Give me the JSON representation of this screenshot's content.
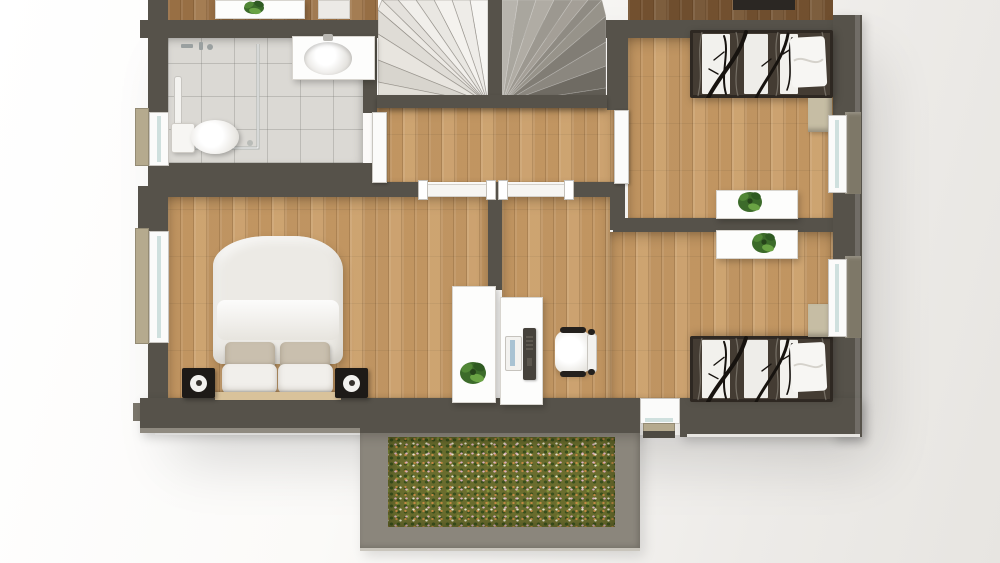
{
  "meta": {
    "description": "3D architectural floor plan, top-down render of an upper storey",
    "view": "top-down orthographic",
    "no_visible_text": true
  },
  "colors": {
    "wall": "#56524a",
    "wallLight": "#8f8a80",
    "woodLight": "#c89d69",
    "woodMid": "#9a7248",
    "woodDark": "#6f4f30",
    "tile": "#dbd9d4",
    "stairWhite": "#f0eeea",
    "stairGray": "#8a867e",
    "grass": "#6a6d2e",
    "balconyFrame": "#8b867c",
    "duvet": "#eceae5",
    "pillowBeige": "#c9bfae",
    "patternDark": "#38322b",
    "glass": "#cfe0de",
    "sill": "#b5aa8e",
    "sillDark": "#7e7868",
    "speaker": "#1d1a17",
    "plantGreen": "#4c7c34",
    "plantDark": "#2f5a22",
    "chairBlack": "#23201d",
    "screen": "#a9c3d3",
    "nightstand": "#c6bda4",
    "headboard": "#d9c29a"
  },
  "rooms": {
    "bathroom": {
      "label": "Bathroom",
      "floor": "grey tile",
      "features": [
        "corner shower",
        "toilet",
        "washbasin counter",
        "window"
      ]
    },
    "staircase": {
      "label": "Staircase",
      "features": [
        "white winder flight",
        "grey winder flight",
        "central spine wall"
      ]
    },
    "hallway": {
      "label": "Hallway",
      "floor": "wood parquet",
      "features": [
        "two door openings",
        "bathroom door",
        "bedroom door"
      ]
    },
    "bedroom_master": {
      "label": "Master bedroom",
      "floor": "wood parquet",
      "features": [
        "double bed with white duvet",
        "two speakers",
        "tall white shelf with plant",
        "window"
      ]
    },
    "office": {
      "label": "Office landing",
      "floor": "wood parquet",
      "features": [
        "white desk",
        "monitor",
        "office chair"
      ]
    },
    "bedroom_top_right": {
      "label": "Bedroom (top right)",
      "floor": "wood parquet",
      "features": [
        "single bed with birch-pattern duvet",
        "white pillow",
        "nightstand",
        "sideboard with plant",
        "window"
      ]
    },
    "bedroom_bottom_right": {
      "label": "Bedroom (bottom right)",
      "floor": "wood parquet",
      "features": [
        "single bed with birch-pattern duvet",
        "white pillow",
        "nightstand",
        "sideboard with plant",
        "window",
        "balcony door"
      ]
    },
    "balcony": {
      "label": "Balcony",
      "surface": "flower meadow / green roof",
      "features": [
        "taupe parapet frame"
      ]
    }
  }
}
